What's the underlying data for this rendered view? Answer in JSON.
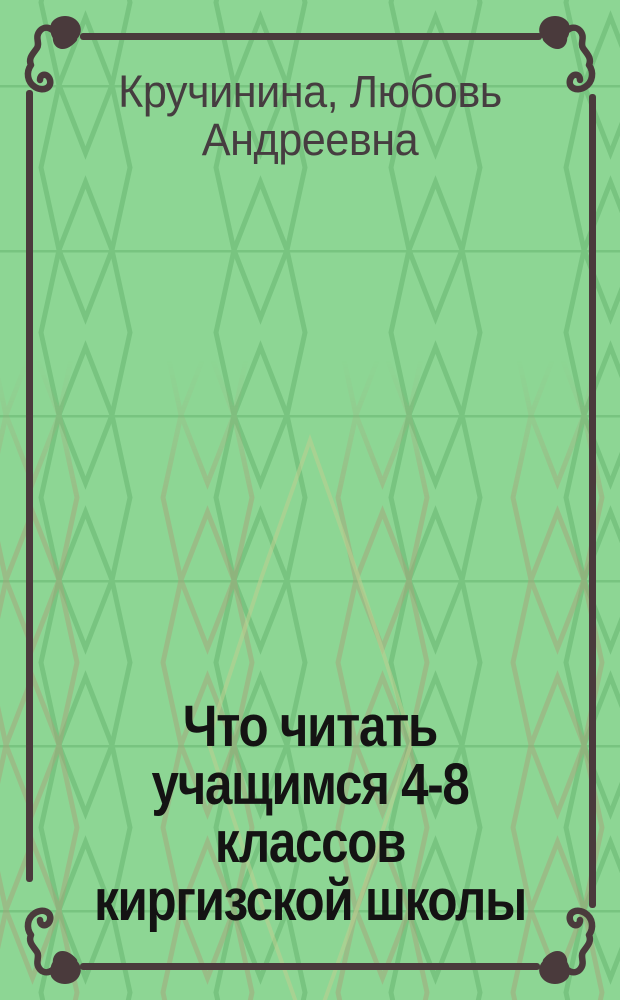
{
  "cover": {
    "author": "Кручинина, Любовь\nАндреевна",
    "title": "Что читать\nучащимся 4-8\nклассов\nкиргизской школы"
  },
  "colors": {
    "background": "#8dd694",
    "pattern_green": "#74c17d",
    "pattern_olive": "#a5a67b",
    "pattern_pale": "#bdd08f",
    "frame": "#4a3a3c",
    "author_text": "#463d40",
    "title_text": "#141313"
  },
  "decorations": {
    "background_pattern": "hexagon-lattice",
    "frame_style": "ornamental rule frame",
    "corner_ornament": "calligraphic-flourish"
  }
}
